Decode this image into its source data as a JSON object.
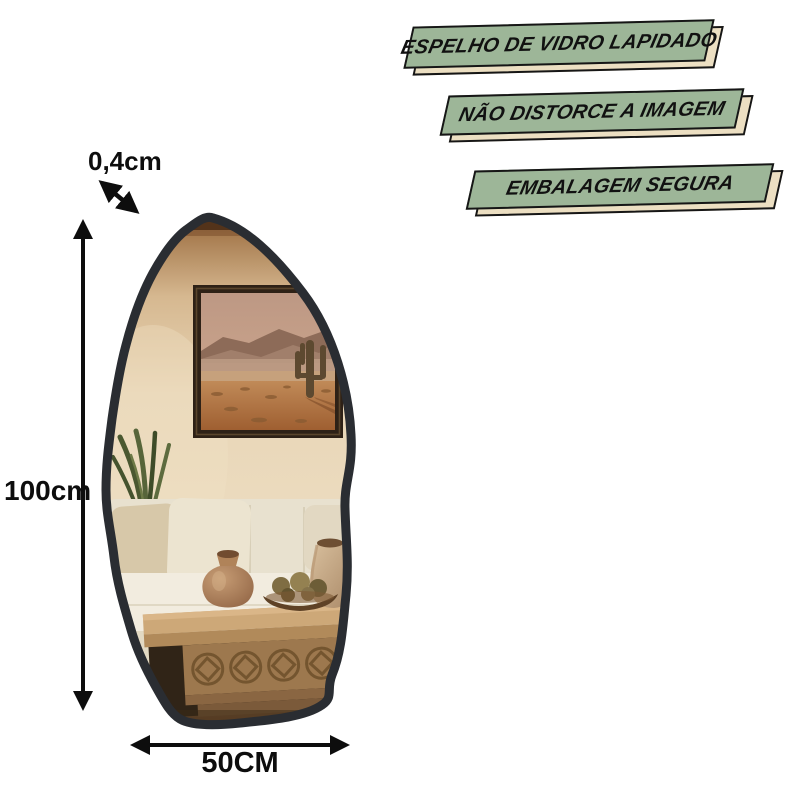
{
  "dimensions": {
    "thickness": "0,4cm",
    "height": "100cm",
    "width": "50CM"
  },
  "banners": [
    {
      "label": "ESPELHO DE VIDRO LAPIDADO"
    },
    {
      "label": "NÃO DISTORCE A IMAGEM"
    },
    {
      "label": "EMBALAGEM SEGURA"
    }
  ],
  "icons": {
    "thickness_arrow": "double-arrow-diagonal",
    "height_arrow": "double-arrow-vertical",
    "width_arrow": "double-arrow-horizontal"
  },
  "colors": {
    "banner_green": "#9db698",
    "banner_shadow_cream": "#ecdfc2",
    "banner_border": "#161616",
    "annotation_black": "#0d0d0d",
    "mirror_frame": "#2a2d32",
    "wall_beige": "#e9d6b7",
    "sofa_ivory": "#f2ecdf",
    "wood_brown": "#a07a4e"
  }
}
